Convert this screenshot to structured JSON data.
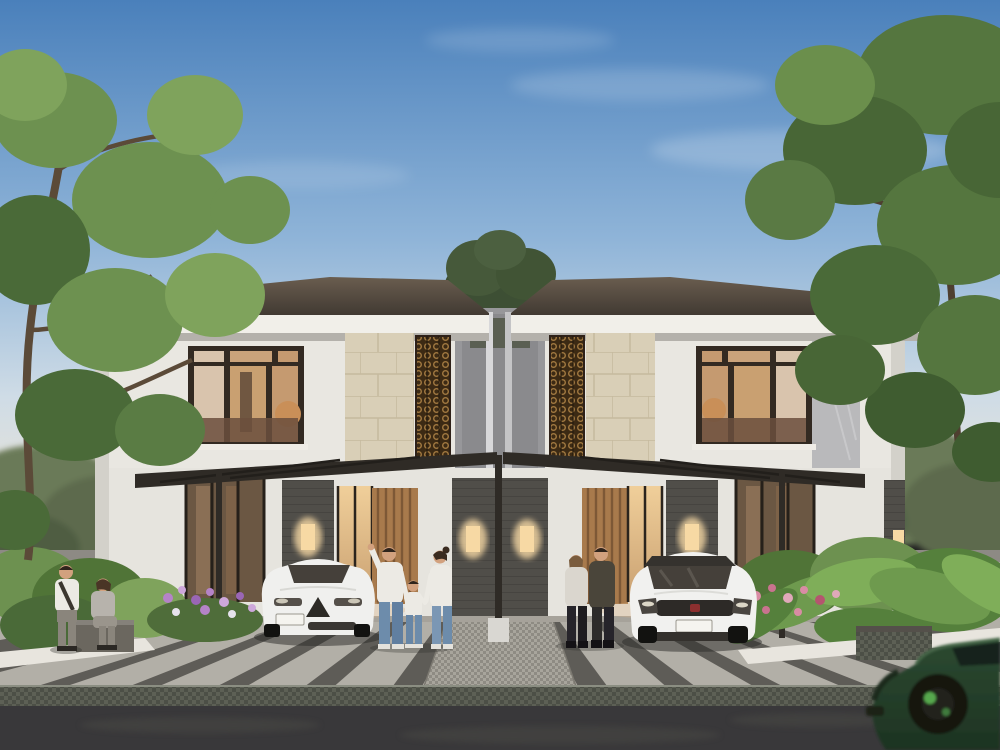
{
  "scene": {
    "type": "architectural-render",
    "description": "Photorealistic dusk rendering of a modern two-storey duplex house with striped driveway, two parked white cars, a passing green car, seven people, tropical landscaping and large framing trees",
    "time_of_day": "dusk",
    "house": {
      "units": 2,
      "storeys": 2,
      "features": [
        "dark hip roof",
        "white plaster walls",
        "beige stone cladding",
        "bronze perforated screens",
        "dark-framed warm-lit windows",
        "carport canopy with slim posts",
        "stacked-stone pillars with wall sconces",
        "wood slat entry doors"
      ]
    },
    "vehicles": [
      {
        "name": "white-sedan",
        "description": "white sedan parked in left carport, front view"
      },
      {
        "name": "white-suv",
        "description": "white compact SUV with dark roof parked in right carport"
      },
      {
        "name": "green-suv",
        "description": "dark green sports SUV driving by on the street, motion blurred"
      }
    ],
    "people": [
      {
        "name": "standing-man-left",
        "description": "man in white shirt with shoulder bag standing by garden"
      },
      {
        "name": "sitting-woman-left",
        "description": "woman in grey seated on stone bench"
      },
      {
        "name": "family-man",
        "description": "father in white tee and jeans pointing upward"
      },
      {
        "name": "family-child",
        "description": "child in white tee and jeans holding hands"
      },
      {
        "name": "family-woman",
        "description": "mother in white tee and jeans"
      },
      {
        "name": "couple-woman",
        "description": "woman in light sweater and dark leggings walking to door"
      },
      {
        "name": "couple-man",
        "description": "man in dark jacket walking to door"
      }
    ],
    "landscape": [
      "large leafy tree upper-left",
      "large leafy tree upper-right",
      "tree between roof gap",
      "purple flower bed left",
      "pink flower bed right",
      "tropical foliage",
      "stone planter cube",
      "stone bench"
    ]
  },
  "palette": {
    "sky_top": "#4a80bb",
    "sky_mid": "#8fb4d8",
    "sky_low": "#cfdce6",
    "sky_horizon": "#efe5d4",
    "roof_dark": "#3f3831",
    "roof_light": "#6a5d4f",
    "fascia": "#f1efe9",
    "fascia_shadow": "#b4b1ab",
    "wall_white": "#e9e7e1",
    "wall_shade": "#d3d1ca",
    "center_wall": "#97979a",
    "stone_beige": "#d9cfb7",
    "stone_grout": "#c6ba9e",
    "bronze_bg": "#3c2a14",
    "bronze_ring": "#a07840",
    "window_frame": "#332a22",
    "interior_warm": "#c9a071",
    "interior_bright": "#f0cf9a",
    "glass_reflect": "#6b4f3d",
    "wood_door": "#a87a4c",
    "wood_dark": "#7d5836",
    "pillar_stone": "#504e49",
    "canopy": "#2f2b26",
    "sconce": "#f7d9a4",
    "paving_light": "#b2afa7",
    "paving_dark": "#56544f",
    "walkway_light": "#a8a59c",
    "cobble_a": "#5d6055",
    "cobble_b": "#4c4f46",
    "asphalt": "#39383a",
    "curb": "#e8e5de",
    "hedge_back": "#5d6b4d",
    "foliage_dark": "#4a6a38",
    "foliage_mid": "#6d9150",
    "foliage_light": "#7fa35c",
    "tropic_leaf": "#6e9a4e",
    "flower_purple": "#b583c8",
    "flower_pink": "#d98ca4",
    "sedan_white": "#f0f0ee",
    "suv_white": "#f1f1ef",
    "car_glass": "#45403a",
    "grille_dark": "#2d2a27",
    "badge_red": "#8c2f2f",
    "plate": "#f5f4ef",
    "green_car": "#2c4a31",
    "green_car_dark": "#1d3322",
    "wheel_black": "#121210",
    "caliper_green": "#57a84e",
    "skin": "#d2a17e",
    "hair_dark": "#2f241c",
    "shirt_white": "#eceae4",
    "denim": "#6d8cab",
    "grey_outfit": "#b7b3ac",
    "jacket_olive": "#4a453a",
    "pants_black": "#26242a",
    "bench_stone": "#6b675f",
    "planter_stone": "#54504a",
    "shadow": "#2a2a28"
  }
}
